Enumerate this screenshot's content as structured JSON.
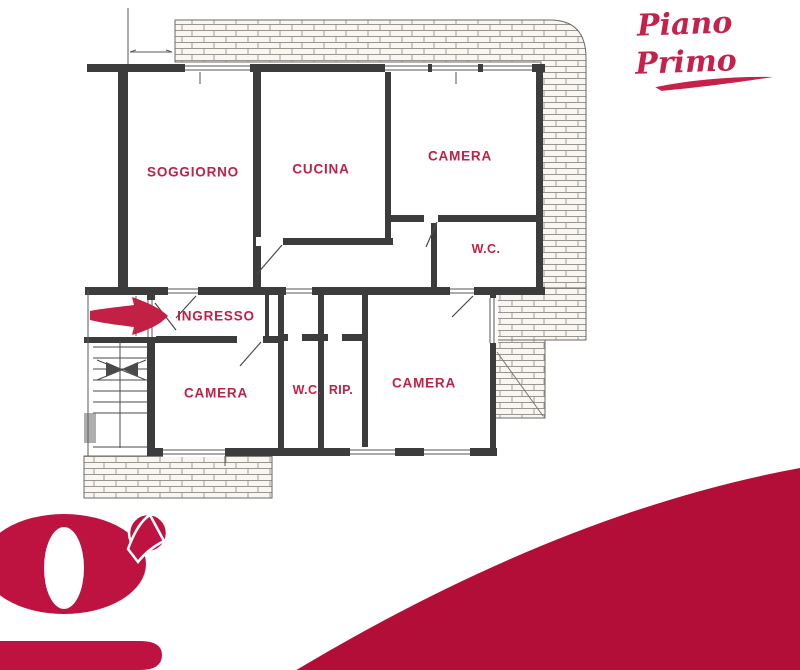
{
  "title": {
    "text": "Piano Primo"
  },
  "floorplan": {
    "rooms": [
      {
        "id": "soggiorno",
        "label": "SOGGIORNO"
      },
      {
        "id": "cucina",
        "label": "CUCINA"
      },
      {
        "id": "camera-nord",
        "label": "CAMERA"
      },
      {
        "id": "wc-nord",
        "label": "W.C."
      },
      {
        "id": "ingresso",
        "label": "INGRESSO"
      },
      {
        "id": "camera-ovest",
        "label": "CAMERA"
      },
      {
        "id": "wc-sud",
        "label": "W.C."
      },
      {
        "id": "ripostiglio",
        "label": "RIP."
      },
      {
        "id": "camera-est",
        "label": "CAMERA"
      }
    ],
    "icons": {
      "entrance_arrow": "right-arrow"
    }
  },
  "logo": {
    "letter": "g"
  },
  "colors": {
    "accent": "#C22045",
    "title": "#C7204A",
    "logo": "#BE1240",
    "wave": "#B30E38",
    "wall": "#3C3C3C",
    "line": "#4A4A4A",
    "brickline": "#9A958D",
    "brickfill": "#F7F6F3"
  }
}
